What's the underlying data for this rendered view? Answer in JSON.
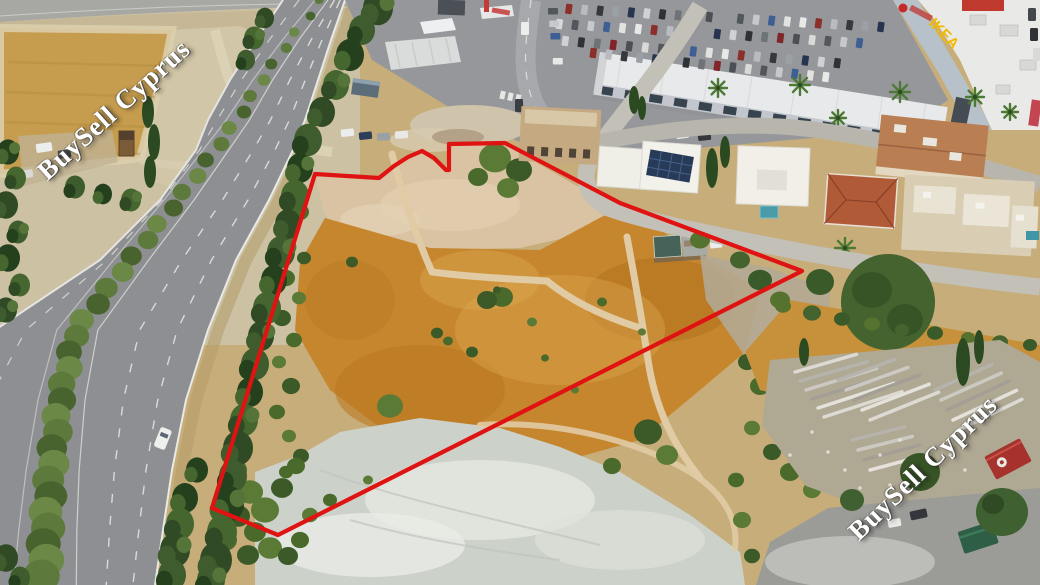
{
  "scene": {
    "type": "aerial-drone-photograph",
    "description": "Aerial photo of a vacant land plot outlined in red, beside a divided highway with a hedge median on the left, a retail car park and warehouse buildings at top, detached houses on the right, and a materials storage yard at bottom right."
  },
  "watermarks": {
    "top_left": "BuySell Cyprus",
    "bottom_right": "BuySell Cyprus"
  },
  "signs": {
    "store_sign": "IKEA"
  },
  "overlay": {
    "plot_boundary_color": "#e01313",
    "boundary_stroke_px": 4.2
  },
  "colors": {
    "boundary_red": "#e01313",
    "watermark_white": "#ffffff",
    "sign_yellow": "#f0bb00",
    "dry_grass_orange": "#c6862e",
    "dirt_cream": "#d9c3a2",
    "chalk_light": "#ccd1ca",
    "asphalt_grey": "#96979b",
    "tree_green": "#3e5c2e",
    "median_green": "#5d7a3c"
  }
}
